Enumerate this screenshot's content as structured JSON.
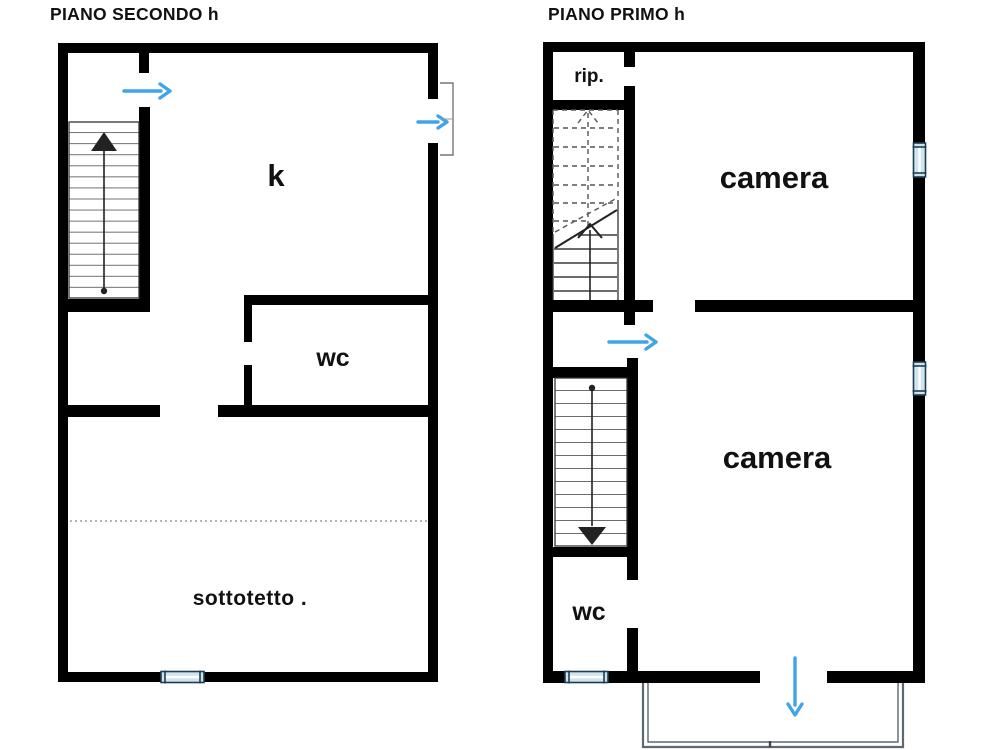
{
  "plans": {
    "piano_secondo": {
      "title": "PIANO SECONDO h",
      "rooms": {
        "kitchen_label": "k",
        "wc_label": "wc",
        "attic_label": "sottotetto ."
      }
    },
    "piano_primo": {
      "title": "PIANO PRIMO h",
      "rooms": {
        "storage_label": "rip.",
        "bedroom_upper_label": "camera",
        "bedroom_lower_label": "camera",
        "wc_label": "wc"
      }
    }
  },
  "colors": {
    "wall": "#000000",
    "door_arrow": "#3fa5e8",
    "window_fill": "#cfe4ef",
    "window_stroke": "#1e3c52",
    "balcony_line": "#5c6873",
    "stair_line": "#3c3c3c",
    "dotted_line": "#9a9a9a",
    "text": "#111111"
  }
}
